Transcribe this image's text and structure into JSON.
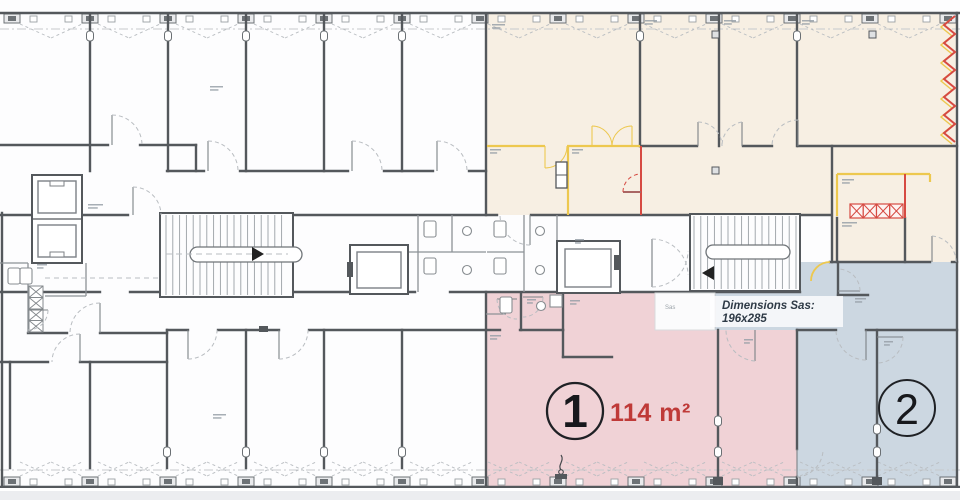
{
  "colors": {
    "wall": "#54585c",
    "cream": "#f7efe3",
    "pink": "#f0d2d6",
    "blue": "#ccd7e1",
    "yellow": "#edc84f",
    "red": "#d64a42",
    "area_text": "#bf3a38",
    "note_text": "#2e3a46"
  },
  "unit1": {
    "number": "1",
    "area": "114 m²"
  },
  "unit2": {
    "number": "2"
  },
  "sas_note": {
    "line1": "Dimensions Sas:",
    "line2": "196x285"
  },
  "sas_room": {
    "label": "Sas"
  }
}
